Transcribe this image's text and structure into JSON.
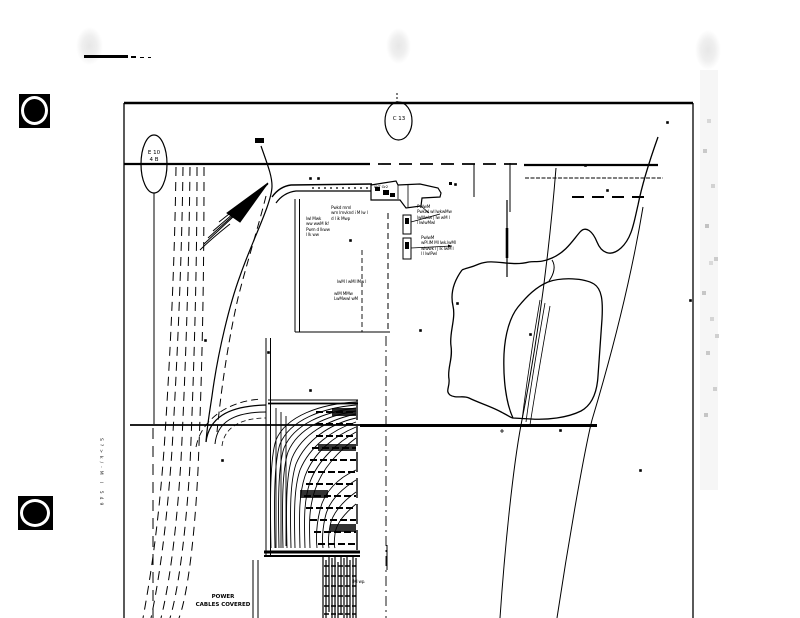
{
  "colors": {
    "ink": "#000000",
    "paper": "#ffffff",
    "smudge": "#e9e9e9",
    "speckle": "#b5b5b5"
  },
  "markers": {
    "matchline_left": {
      "line1": "E 10",
      "line2": "4 B"
    },
    "matchline_top": {
      "label": "C 13"
    }
  },
  "labels": {
    "power": {
      "line1": "POWER",
      "line2": "CABLES COVERED"
    },
    "building": {
      "l1": "IWT Gr2"
    },
    "edge_text": {
      "l1": "S?>k/-M l 549"
    }
  },
  "annotations": {
    "a1": {
      "l1": "Pwkd mml",
      "l2": "wm lmvknd i M lw l",
      "l3": "d l ik Mwp"
    },
    "a2": {
      "l1": "lwl Mwk",
      "l2": "ww wwM lk!",
      "l3": "Pwm d lkww",
      "l4": "l lk ww"
    },
    "a3": {
      "l1": "PwlwM",
      "l2": "Pwkwl wl lwkwMw",
      "l3": "lwMwlw | lw wM l",
      "l4": "l lwlwMwl"
    },
    "a4": {
      "l1": "PwlwM",
      "l2": "wPl.lM Ml lwk.lwMl",
      "l3": "wlwwk l | lk lwM l",
      "l4": "l l lwlPwl"
    },
    "a5": {
      "l1": "lwM l wMl lMw l"
    },
    "a6": {
      "l1": "wlM MMw",
      "l2": "LwMwwl wM"
    },
    "a7": {
      "l1": "lMl wp."
    }
  }
}
